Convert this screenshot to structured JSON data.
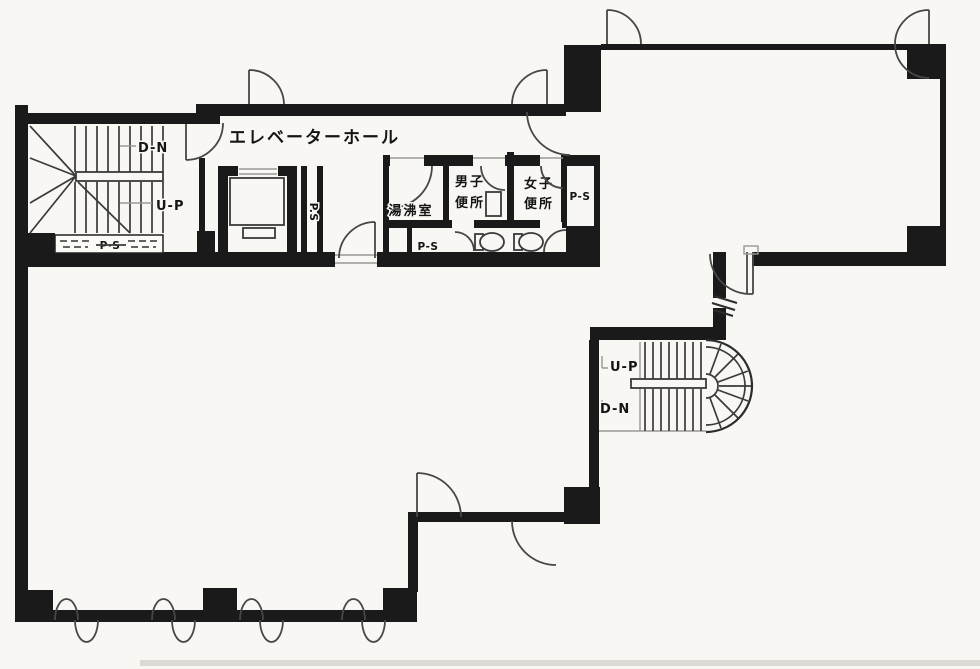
{
  "floorplan": {
    "elevator_hall": {
      "label": "エレベーターホール"
    },
    "stair_left": {
      "down": "D-N",
      "up": "U-P",
      "pipe_shaft": "P·S"
    },
    "elevator_pipe_shaft": {
      "label": "P.S"
    },
    "kitchenette": {
      "label": "湯沸室",
      "pipe_shaft": "P-S"
    },
    "mens_toilet": {
      "line1": "男子",
      "line2": "便所"
    },
    "womens_toilet": {
      "line1": "女子",
      "line2": "便所"
    },
    "right_pipe_shaft": {
      "label": "P-S"
    },
    "stair_right": {
      "up": "U-P",
      "down": "D-N"
    },
    "colors": {
      "wall": "#1a1a1a",
      "line": "#3a3a3a",
      "paper": "#f8f7f4"
    }
  }
}
